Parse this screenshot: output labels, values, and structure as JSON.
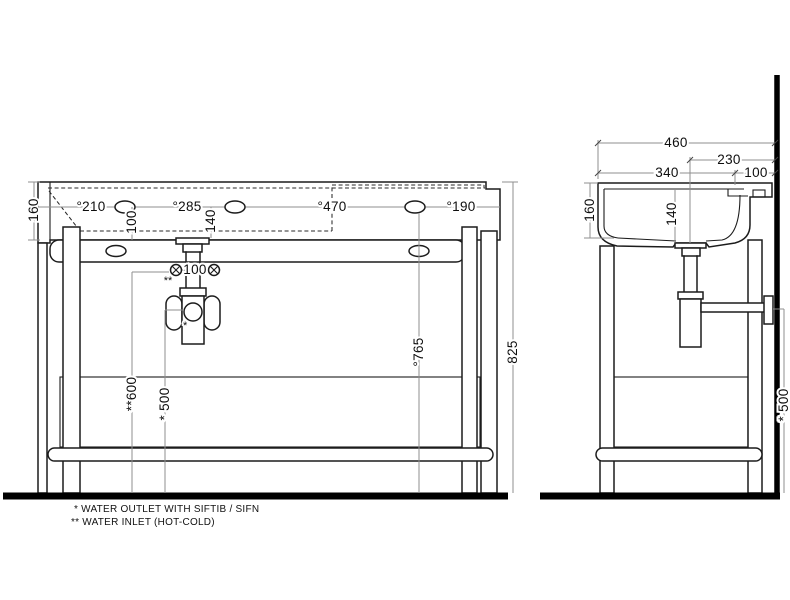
{
  "drawing_type": "washbasin console technical dimension drawing",
  "colors": {
    "object_line": "#1c1c1c",
    "dimension_line": "#8f8f8f",
    "wall_floor": "#000000",
    "background": "#ffffff"
  },
  "front": {
    "rim_height": "160",
    "hole_210": "°210",
    "hole_285": "°285",
    "hole_470": "°470",
    "hole_190": "°190",
    "hole_offset_100": "100",
    "hole_offset_140": "140",
    "inlet_spacing_100": "100",
    "inlet_ref": "**",
    "outlet_ref": "*",
    "inlet_height_600": "**600",
    "outlet_height_500": "* 500",
    "fixing_height_765": "°765",
    "total_height_825": "825"
  },
  "side": {
    "total_depth_460": "460",
    "drain_to_wall_230": "230",
    "front_to_tap_340": "340",
    "tap_to_wall_100": "100",
    "rim_height_160": "160",
    "bowl_depth_140": "140",
    "outlet_height_500": "* 500"
  },
  "footnotes": {
    "outlet": "*  WATER OUTLET WITH SIFTIB / SIFN",
    "inlet": "** WATER INLET  (HOT-COLD)"
  }
}
